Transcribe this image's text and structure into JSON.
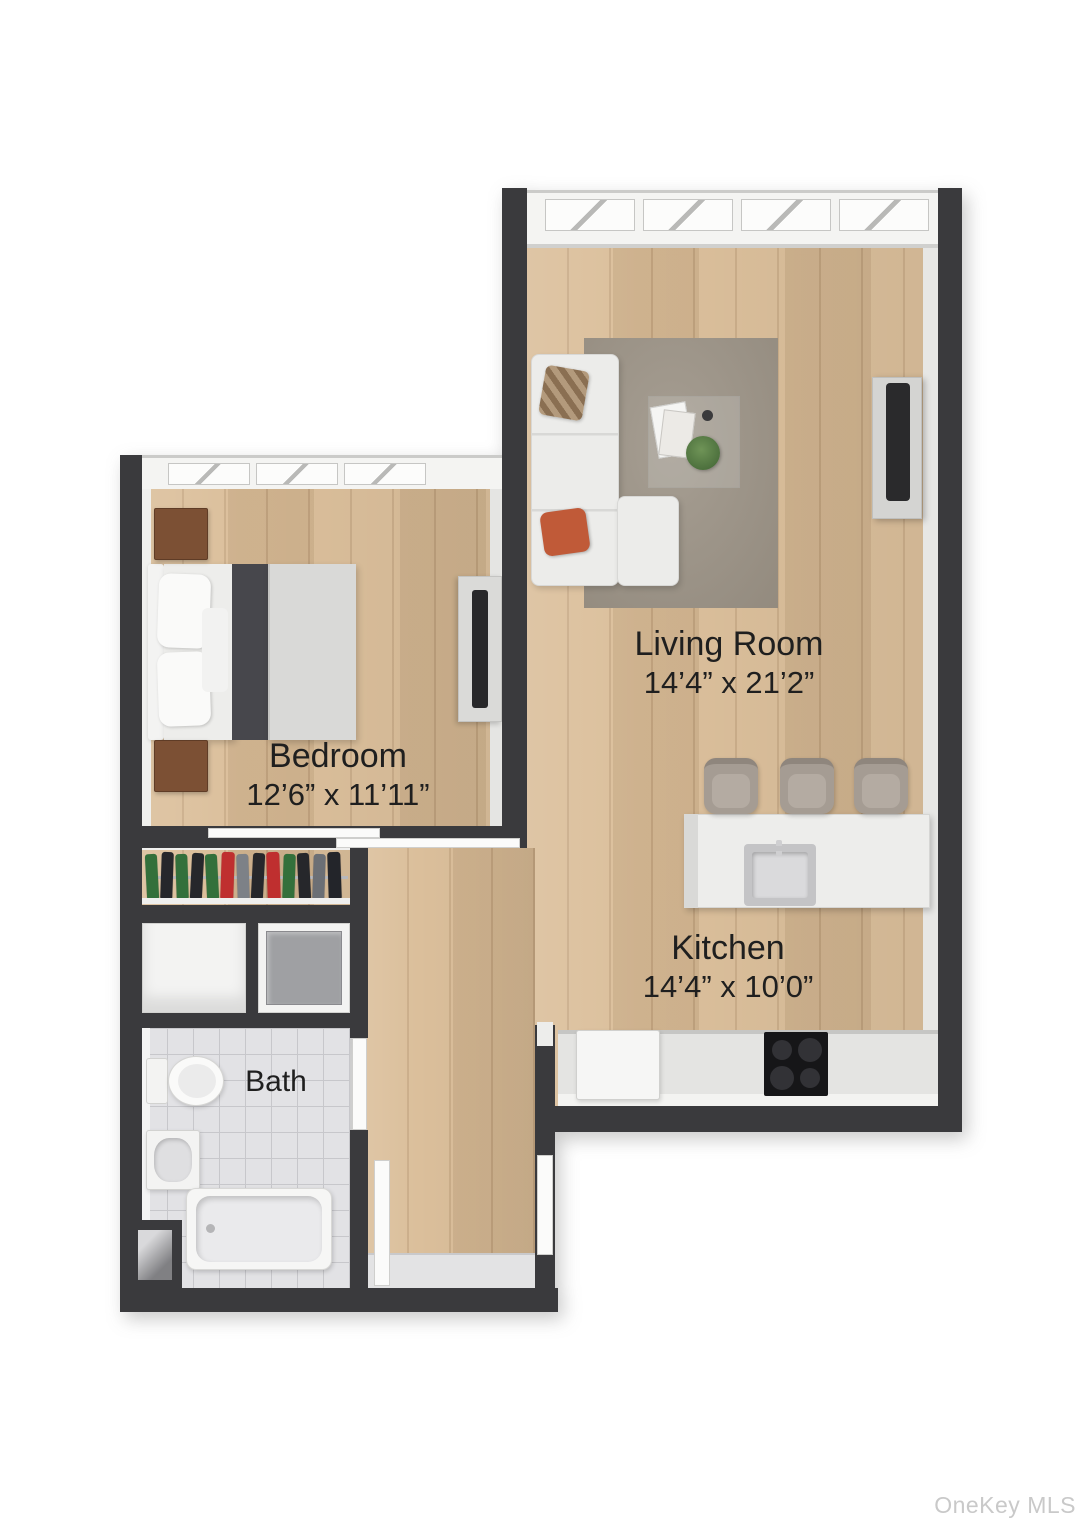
{
  "document": {
    "title": "Apartment Floor Plan",
    "style": "3D rendered top-down floor plan"
  },
  "rooms": {
    "living_room": {
      "label": "Living Room",
      "dimensions": "14’4” x 21’2”"
    },
    "bedroom": {
      "label": "Bedroom",
      "dimensions": "12’6” x 11’11”"
    },
    "kitchen": {
      "label": "Kitchen",
      "dimensions": "14’4” x 10’0”"
    },
    "bath": {
      "label": "Bath"
    }
  },
  "watermark": {
    "label": "OneKey MLS",
    "color": "#c9c9c9"
  },
  "palette": {
    "wall": "#3a3a3d",
    "wood_floor": "#d9bb95",
    "tile_floor": "#e2e2e5",
    "rug": "#9c9386",
    "accent_pillow": "#c05a38",
    "blanket": "#47474c",
    "cooktop": "#161618",
    "label_text": "#1f1f1f",
    "background": "#ffffff"
  },
  "furniture": {
    "living_room": [
      "sectional-sofa",
      "area-rug",
      "coffee-table",
      "magazines",
      "plant",
      "tv-console"
    ],
    "kitchen": [
      "kitchen-island",
      "island-sink",
      "bar-stools",
      "counter",
      "cooktop",
      "appliance"
    ],
    "bedroom": [
      "double-bed",
      "pillows",
      "nightstands",
      "tv-console",
      "closet-rack",
      "storage-closets"
    ],
    "bath": [
      "toilet",
      "pedestal-sink",
      "bathtub"
    ]
  }
}
